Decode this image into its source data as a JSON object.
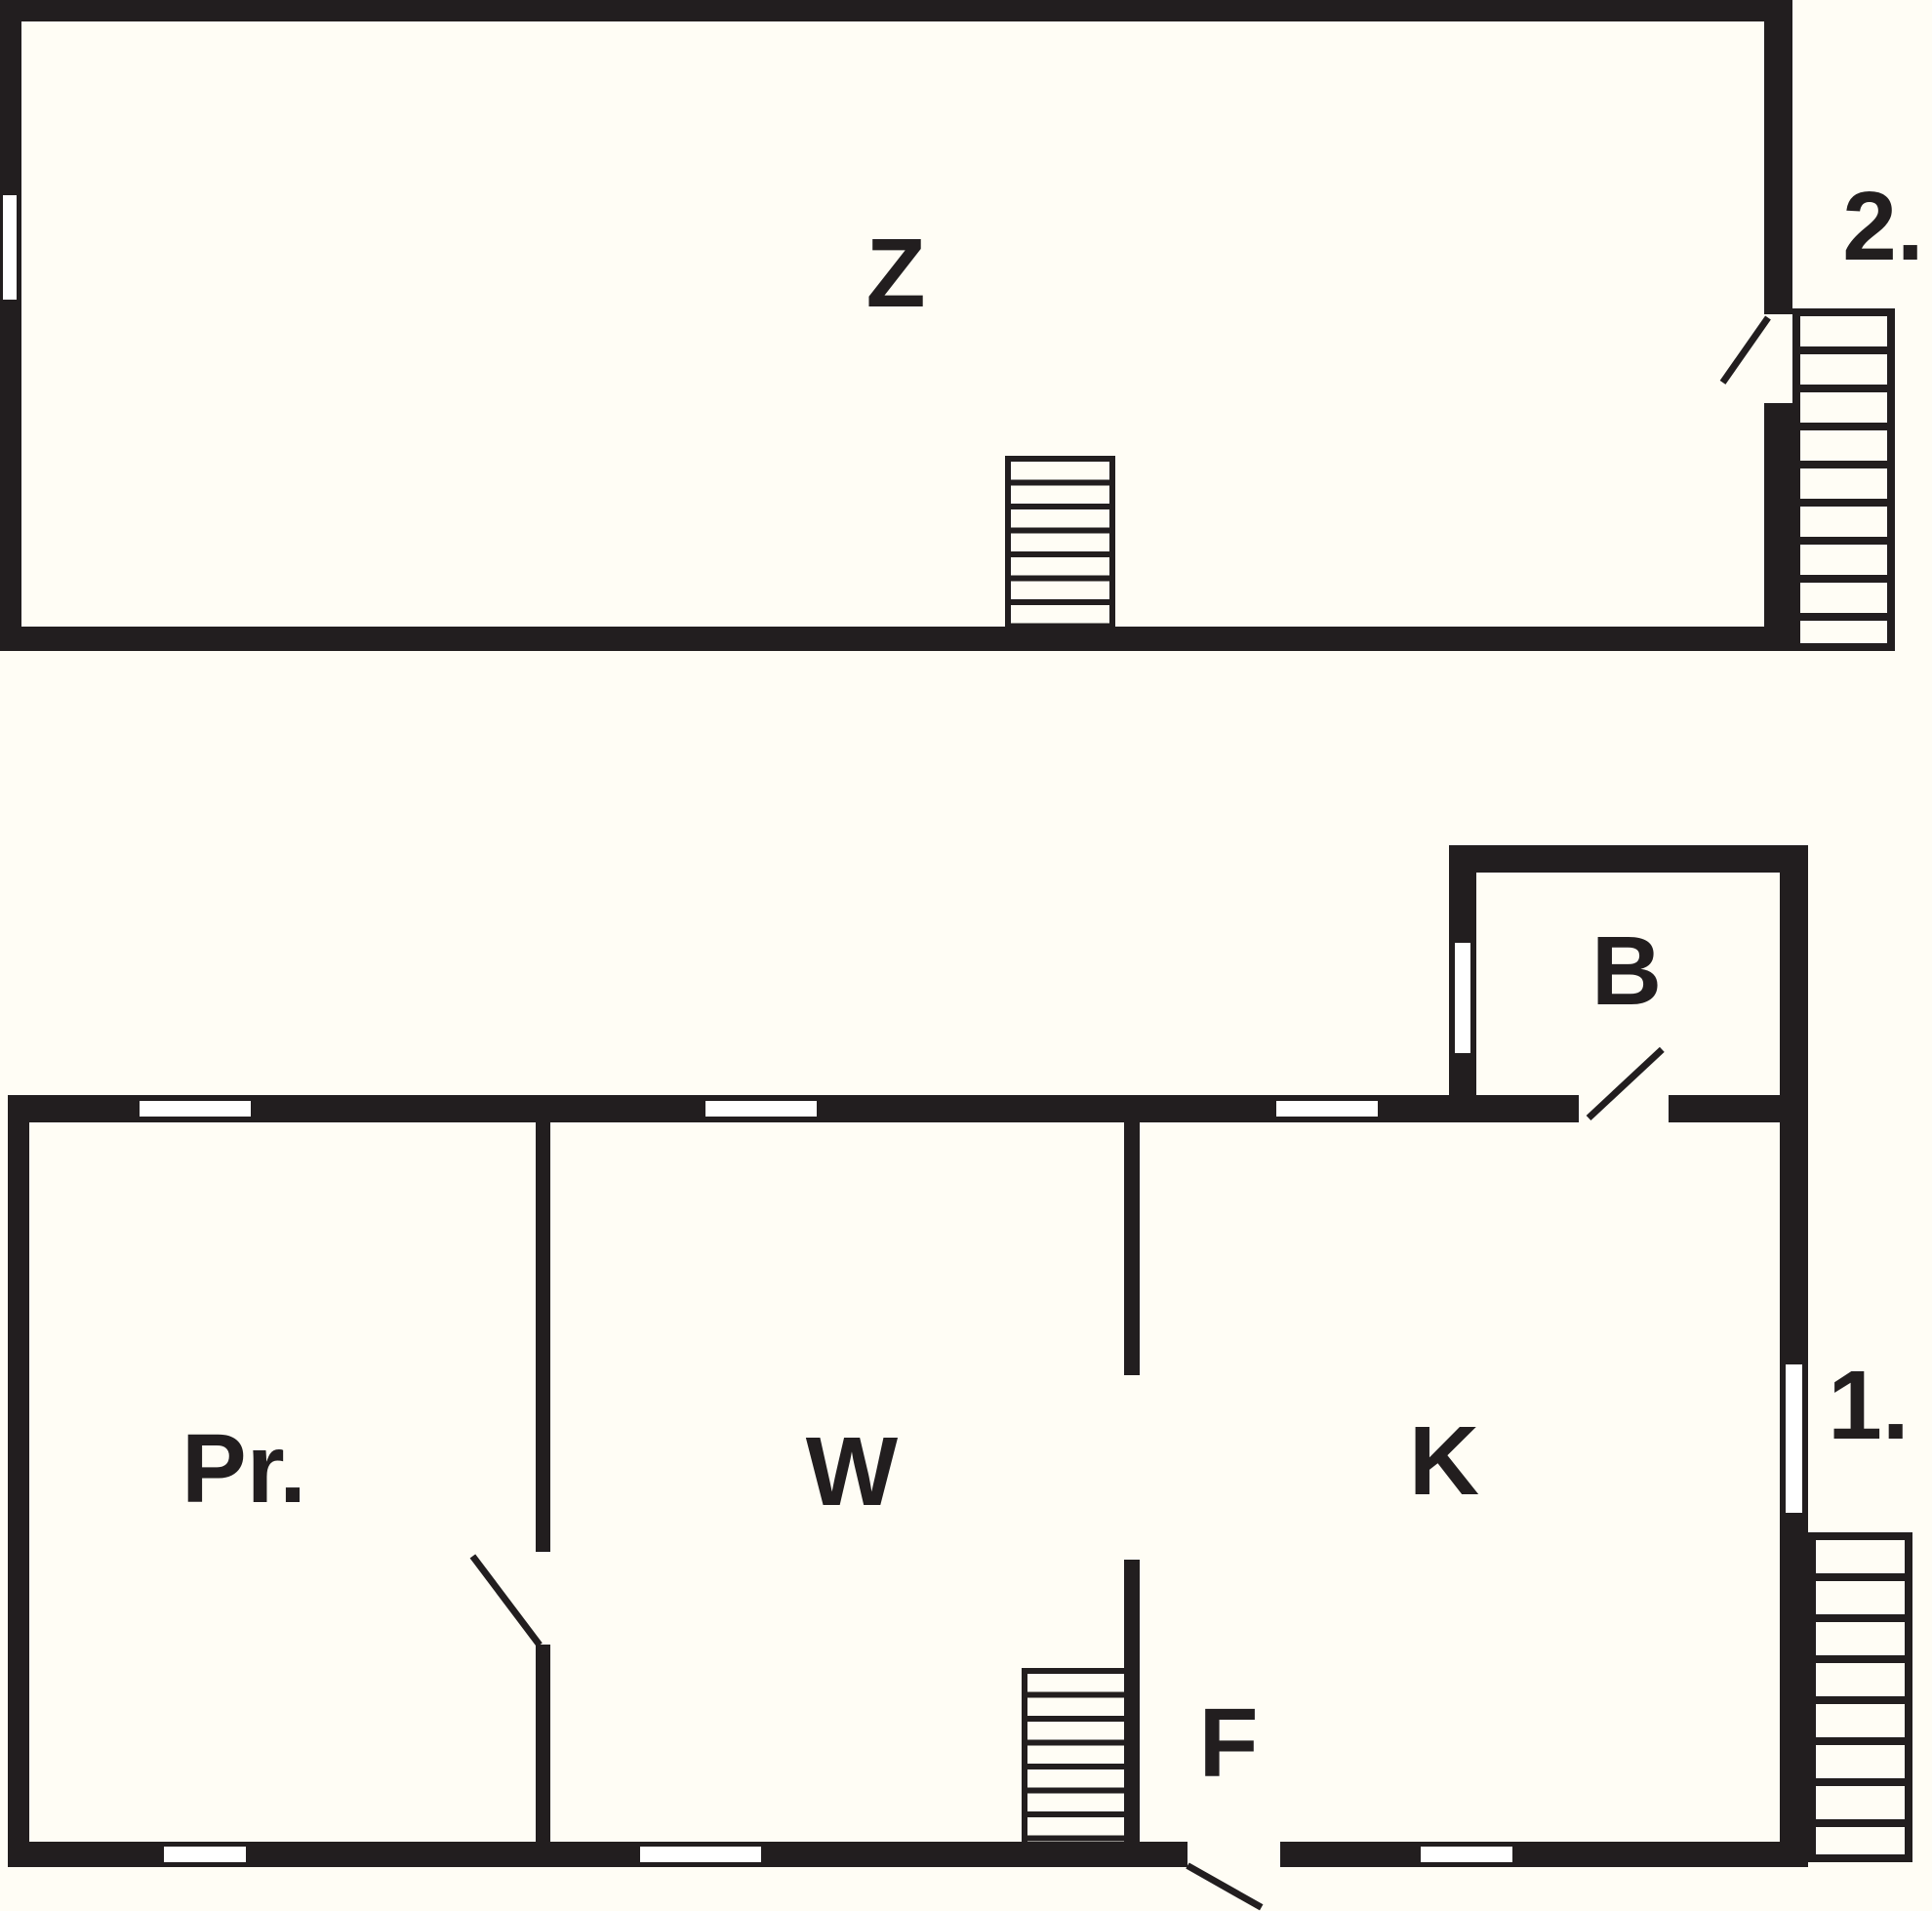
{
  "document": {
    "type": "floor-plan",
    "floor_count": 2
  },
  "colors": {
    "background": "#fffdf5",
    "wall": "#221e1f",
    "window_fill": "#ffffff"
  },
  "upper_floor": {
    "floor_label": "2.",
    "rooms": {
      "z": "Z"
    },
    "features": {
      "interior_stairs_steps": 7,
      "exterior_stairs_steps": 9,
      "windows": 1,
      "doors": 1
    }
  },
  "lower_floor": {
    "floor_label": "1.",
    "rooms": {
      "pr": "Pr.",
      "w": "W",
      "k": "K",
      "f": "F",
      "b": "B"
    },
    "features": {
      "interior_stairs_steps": 7,
      "exterior_stairs_steps": 8,
      "windows": 8,
      "doors": 3
    }
  }
}
